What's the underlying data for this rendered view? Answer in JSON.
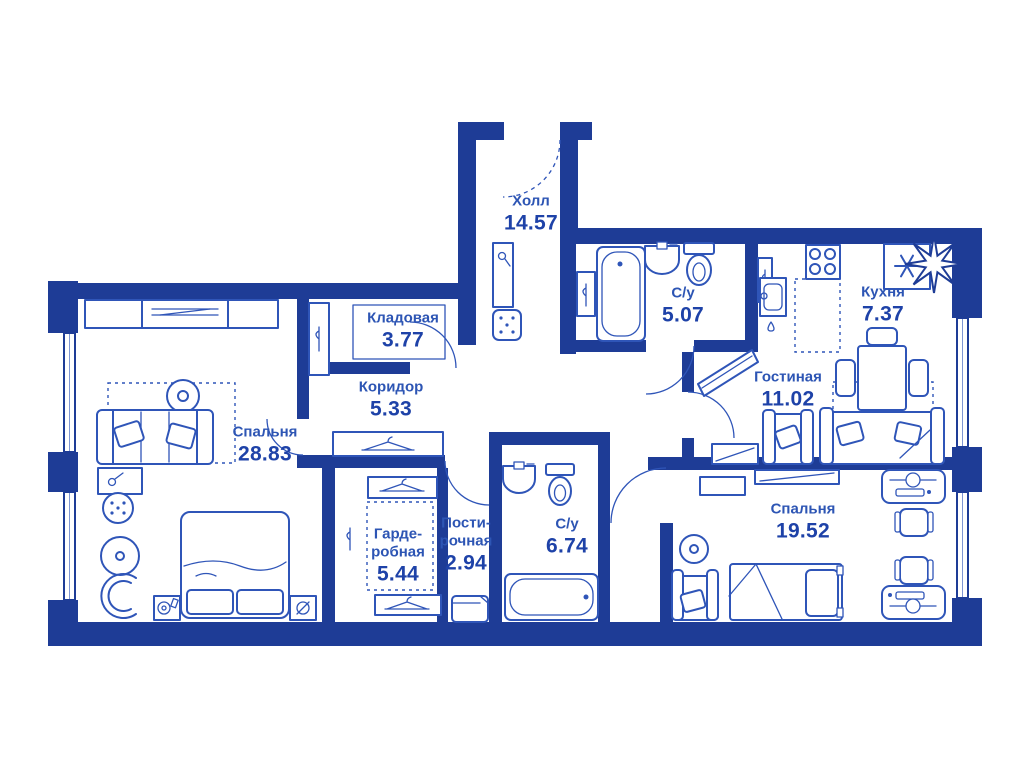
{
  "meta": {
    "view_title": "Apartment floor plan"
  },
  "colors": {
    "wall": "#1e3c96",
    "furniture": "#2f55b8",
    "room_name": "#2d55b4",
    "room_area": "#1e42a8",
    "background": "#ffffff"
  },
  "rooms": [
    {
      "id": "hall",
      "name": "Холл",
      "area": "14.57"
    },
    {
      "id": "storage",
      "name": "Кладовая",
      "area": "3.77"
    },
    {
      "id": "corridor",
      "name": "Коридор",
      "area": "5.33"
    },
    {
      "id": "bedroom-1",
      "name": "Спальня",
      "area": "28.83"
    },
    {
      "id": "bathroom-1",
      "name": "С/у",
      "area": "5.07"
    },
    {
      "id": "kitchen",
      "name": "Кухня",
      "area": "7.37"
    },
    {
      "id": "living-room",
      "name": "Гостиная",
      "area": "11.02"
    },
    {
      "id": "wardrobe",
      "name": "Гарде-\nробная",
      "area": "5.44"
    },
    {
      "id": "laundry",
      "name": "Пости-\nрочная",
      "area": "2.94"
    },
    {
      "id": "bathroom-2",
      "name": "С/у",
      "area": "6.74"
    },
    {
      "id": "bedroom-2",
      "name": "Спальня",
      "area": "19.52"
    }
  ],
  "icons": {
    "fridge_snowflake": "six-spoke asterisk",
    "north_arrow": "eight-point compass star",
    "hanger": "coat-hanger",
    "water_drop": "droplet"
  }
}
